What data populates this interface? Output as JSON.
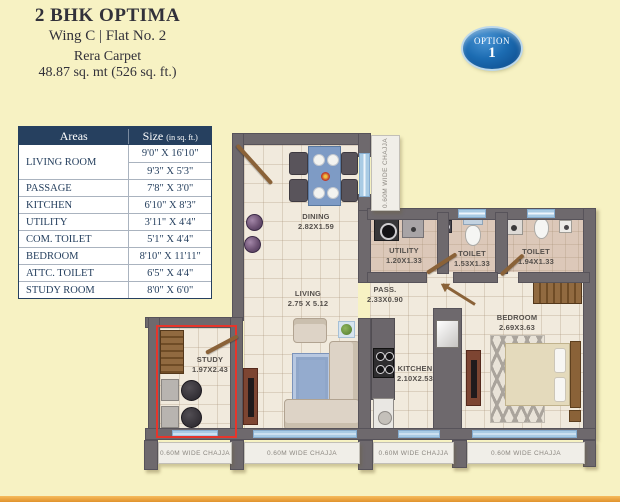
{
  "header": {
    "title": "2 BHK OPTIMA",
    "subtitle": "Wing C  |  Flat No. 2",
    "rera_label": "Rera Carpet",
    "rera_value": "48.87 sq. mt (526 sq. ft.)",
    "option": {
      "label": "OPTION",
      "number": "1"
    }
  },
  "areas_table": {
    "header": {
      "areas": "Areas",
      "size": "Size",
      "size_unit": "(in sq. ft.)"
    },
    "living": {
      "area": "LIVING ROOM",
      "size1": "9'0\" X 16'10\"",
      "size2": "9'3\" X 5'3\""
    },
    "rows": [
      {
        "area": "PASSAGE",
        "size": "7'8\" X 3'0\""
      },
      {
        "area": "KITCHEN",
        "size": "6'10\" X 8'3\""
      },
      {
        "area": "UTILITY",
        "size": "3'11\" X 4'4\""
      },
      {
        "area": "COM. TOILET",
        "size": "5'1\" X 4'4\""
      },
      {
        "area": "BEDROOM",
        "size": "8'10\" X 11'11\""
      },
      {
        "area": "ATTC. TOILET",
        "size": "6'5\" X 4'4\""
      },
      {
        "area": "STUDY ROOM",
        "size": "8'0\" X 6'0\""
      }
    ]
  },
  "floorplan": {
    "rooms": [
      {
        "name": "DINING",
        "dims": "2.82X1.59"
      },
      {
        "name": "LIVING",
        "dims": "2.75 X 5.12"
      },
      {
        "name": "PASS.",
        "dims": "2.33X0.90"
      },
      {
        "name": "UTILITY",
        "dims": "1.20X1.33"
      },
      {
        "name": "TOILET",
        "dims": "1.53X1.33"
      },
      {
        "name": "TOILET",
        "dims": "1.94X1.33"
      },
      {
        "name": "KITCHEN",
        "dims": "2.10X2.53"
      },
      {
        "name": "BEDROOM",
        "dims": "2.69X3.63"
      },
      {
        "name": "STUDY",
        "dims": "1.97X2.43"
      }
    ],
    "chajja_label": "0.60M WIDE CHAJJA"
  },
  "colors": {
    "background": "#f7f2c3",
    "navy": "#26405f",
    "wall_gray": "#6e696d",
    "window_blue": "#a9cbe4",
    "highlight_red": "#e6352b",
    "badge_blue": "#1c6cb2",
    "accent_orange": "#e0922c"
  }
}
